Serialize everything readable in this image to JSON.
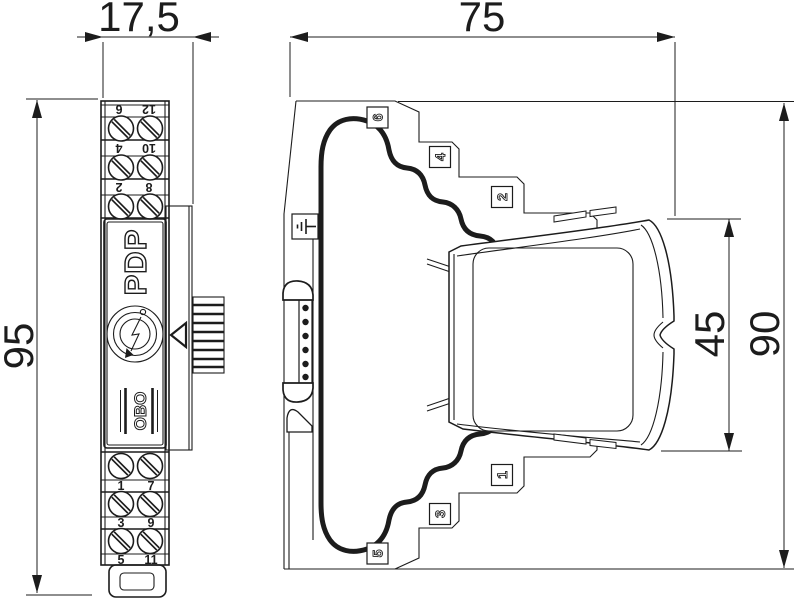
{
  "dimensions": {
    "front_width": "17,5",
    "front_height": "95",
    "side_depth": "75",
    "module_height": "45",
    "side_height": "90"
  },
  "front_view": {
    "model": "PDP",
    "brand": "OBO",
    "top_terminal_rows": [
      {
        "left": "12",
        "right": "6"
      },
      {
        "left": "10",
        "right": "4"
      },
      {
        "left": "8",
        "right": "2"
      }
    ],
    "bottom_terminal_rows": [
      {
        "left": "1",
        "right": "7"
      },
      {
        "left": "3",
        "right": "9"
      },
      {
        "left": "5",
        "right": "11"
      }
    ]
  },
  "side_view": {
    "contact_labels": [
      "6",
      "4",
      "2",
      "1",
      "3",
      "5"
    ]
  }
}
